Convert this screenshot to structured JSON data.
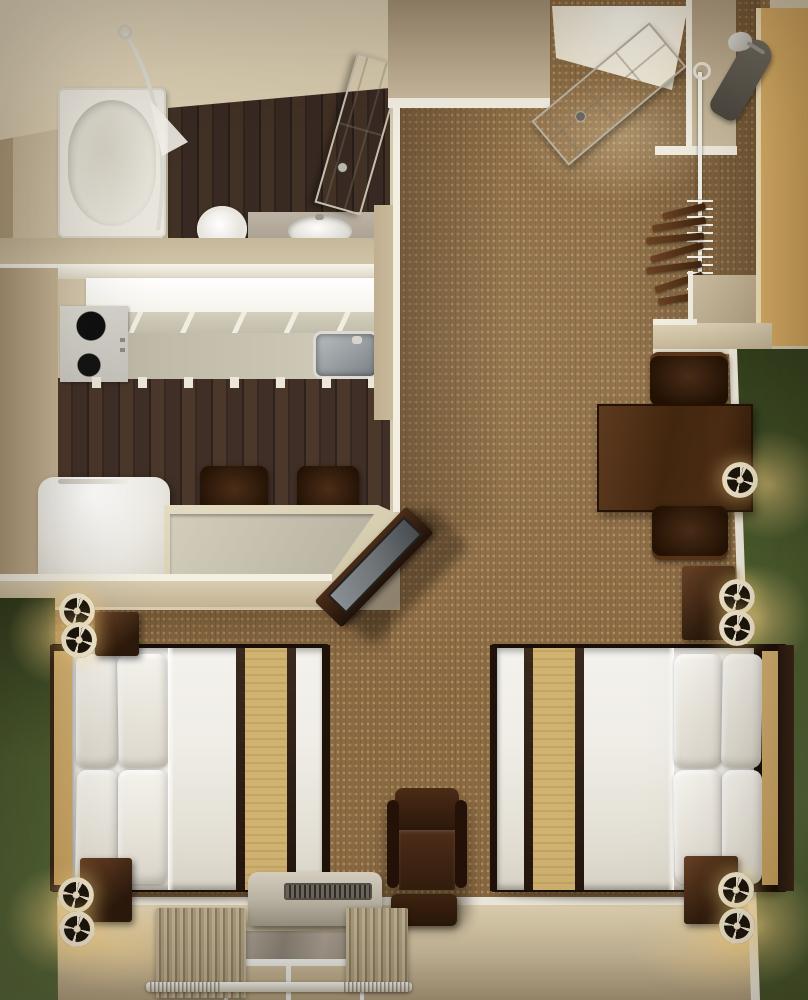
{
  "scene": {
    "label": "hotel-studio-room-floor-plan-3d-top-view",
    "rooms": [
      "bathroom",
      "kitchenette",
      "entry",
      "closet",
      "main-room",
      "dining-nook"
    ],
    "furniture": [
      "bathtub",
      "shower-curtain-rod",
      "toilet",
      "vanity-sink",
      "bathroom-door",
      "upper-cabinets",
      "range-cooktop",
      "kitchen-counter",
      "kitchen-sink",
      "breakfast-bar",
      "bar-chair-left",
      "bar-chair-right",
      "refrigerator",
      "tv-stand",
      "tv",
      "entry-door",
      "ironing-board",
      "iron",
      "closet-rod",
      "hangers",
      "closet-shelf-items",
      "closet-panel",
      "dining-table",
      "dining-chair-top",
      "dining-chair-bottom",
      "wall-sconce",
      "queen-bed-left",
      "queen-bed-right",
      "nightstand-left-top",
      "nightstand-left-bottom",
      "nightstand-right-top",
      "nightstand-right-bottom",
      "table-lamps",
      "armchair",
      "ottoman",
      "ptac-air-conditioner",
      "window",
      "window-sill",
      "curtain-left",
      "curtain-right",
      "curtain-rod"
    ]
  },
  "colors": {
    "wall_cream": "#d8ccb2",
    "wall_beige": "#bfae90",
    "wall_beige_dark": "#a6946f",
    "trim": "#f2eee1",
    "green_wall": "#4e6130",
    "green_wall_dark": "#33401d",
    "carpet": "#8a6a43",
    "carpet_dot": "#b08c5c",
    "wood_floor": "#46332a",
    "bed_white": "#efede6",
    "runner_tan": "#d0b271",
    "headboard_tan": "#c9a360",
    "dark_wood": "#2c1a0c",
    "mid_wood": "#5a3822",
    "table_wood": "#43270f",
    "chair_brown": "#241204",
    "lamp_shade": "#f1e7cb",
    "lamp_glow": "#ffd98c",
    "cabinet_white": "#f6f4ec",
    "counter": "#c9c3b1",
    "steel": "#8f9496",
    "fridge": "#eceae3",
    "tub": "#e9e6de",
    "maple": "#ddb36a",
    "ac_body": "#c0b9a9",
    "ac_vent": "#57514a",
    "marble": "#a89e91",
    "curtain": "#ac9e80",
    "curtain_dark": "#8d7f62",
    "glass": "#c9d2d4",
    "tv_screen": "#6e7477",
    "door_light": "#fffdf6",
    "floor_beige": "#cfc0a0"
  }
}
